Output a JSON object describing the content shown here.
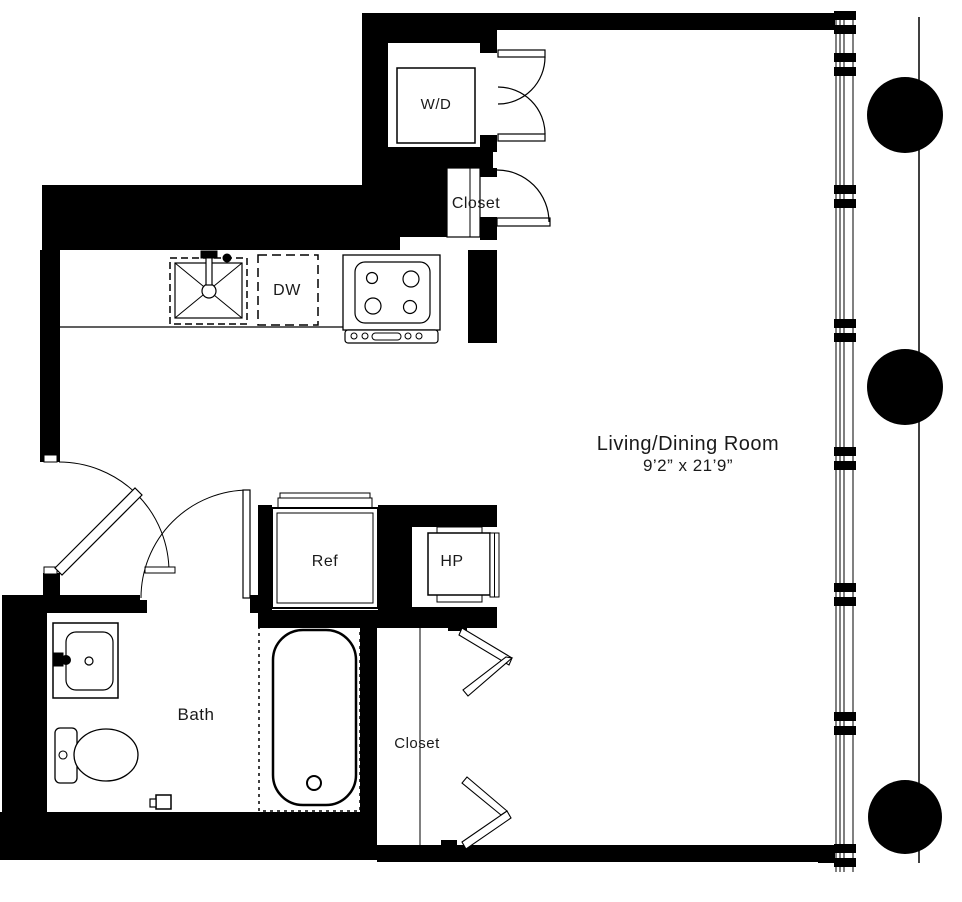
{
  "plan": {
    "type": "apartment-floor-plan",
    "labels": {
      "washer_dryer": "W/D",
      "upper_closet": "Closet",
      "dishwasher": "DW",
      "living_room_name": "Living/Dining Room",
      "living_room_dims": "9’2” x 21’9”",
      "refrigerator": "Ref",
      "heat_pump": "HP",
      "bath": "Bath",
      "lower_closet": "Closet"
    },
    "colors": {
      "wall": "#000000",
      "background": "#ffffff",
      "line": "#1a1a1a"
    }
  }
}
